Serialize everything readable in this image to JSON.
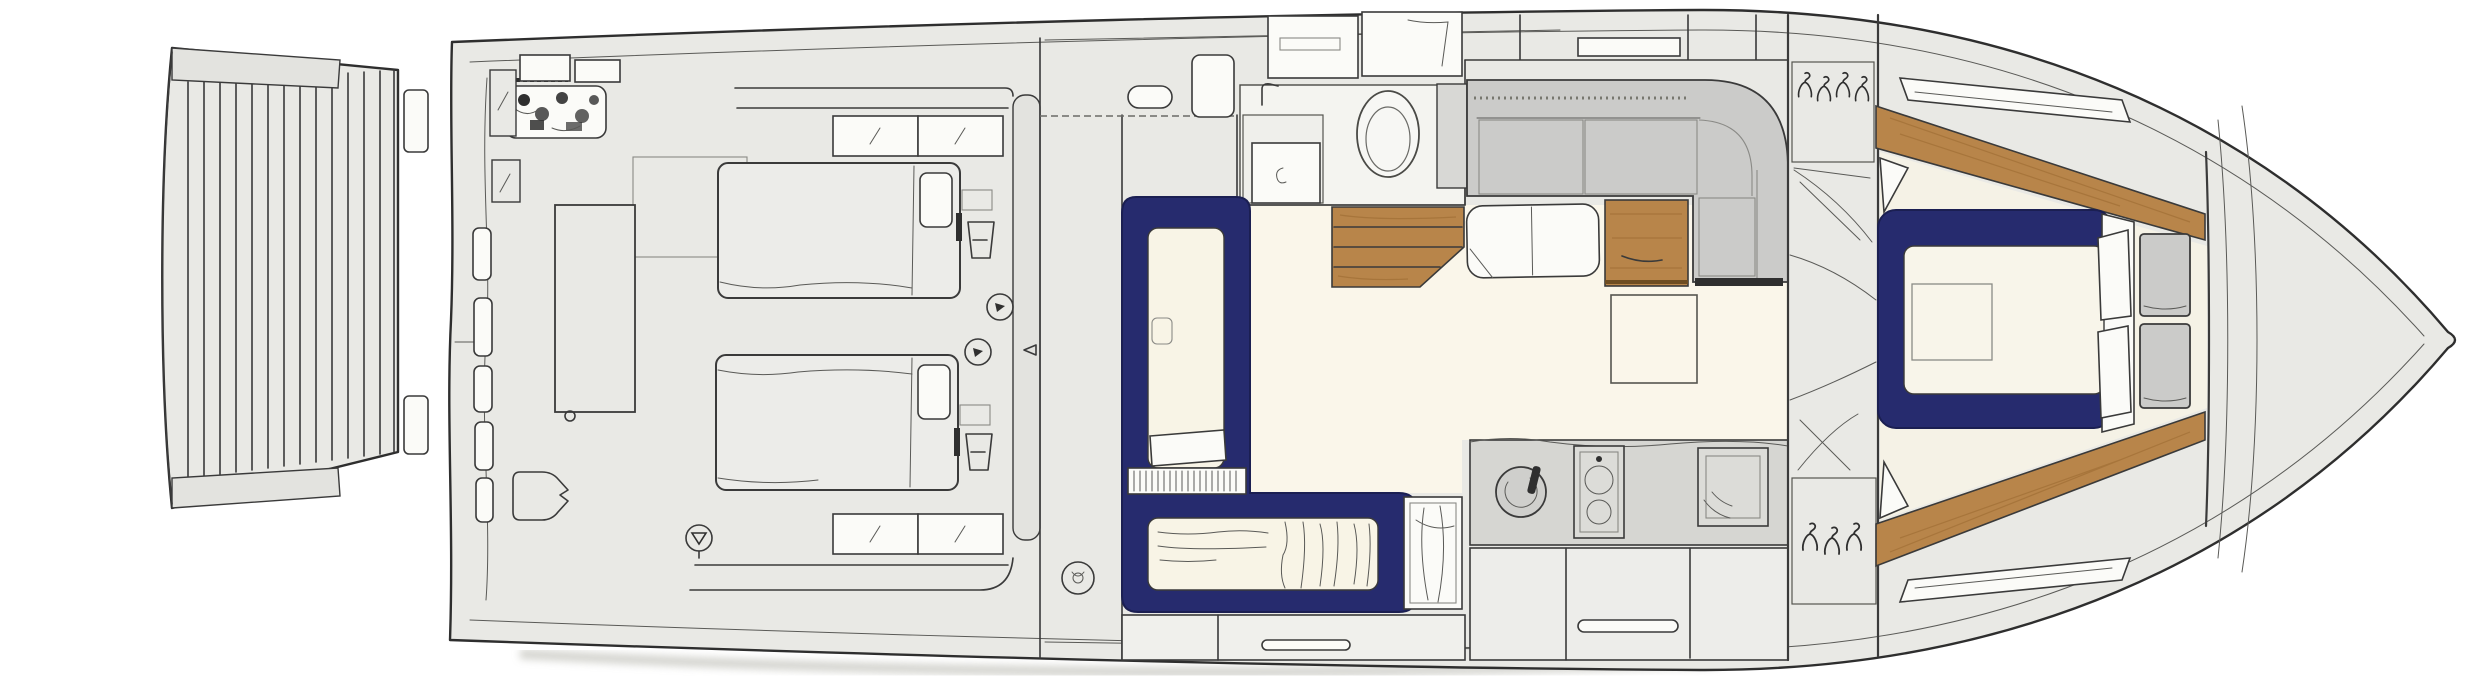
{
  "meta": {
    "title": "Motor yacht lower-deck floor plan",
    "width_px": 2480,
    "height_px": 680,
    "orientation": "bow-right"
  },
  "colors": {
    "hull": "#e9e9e5",
    "line": "#3a3a3a",
    "navy": "#262b6e",
    "cream": "#f8f4e6",
    "floor": "#faf6ea",
    "wood": "#b8854a",
    "grain": "#99672f",
    "gray": "#cbcbc9",
    "graydark": "#9f9f9d",
    "counter": "#d6d6d2",
    "white": "#fbfbf8",
    "shadow": "#c6c6bf",
    "panel": "#e3e3df"
  },
  "rooms": {
    "swim_platform": {
      "label": "Swim platform with teak planking",
      "plank_count": 14
    },
    "transom": {
      "label": "Transom and boarding steps",
      "step_pads": 2
    },
    "aft_cabin": {
      "label": "Aft guest cabin with twin beds",
      "fixtures": [
        "twin-bed-port",
        "twin-bed-starboard",
        "headboard-console",
        "nightstand-lamps",
        "reading-lights",
        "tall-table",
        "seat",
        "equipment-locker",
        "storage-lockers",
        "hull-window-strips",
        "window-boxes",
        "compass-marker"
      ],
      "window_boxes_top": 2,
      "window_boxes_bottom": 2,
      "hull_window_strips": 5
    },
    "corridor": {
      "label": "Side corridor",
      "fixtures": [
        "deck-fitting",
        "bench-pill",
        "side-table"
      ]
    },
    "bunk_cabin": {
      "label": "Guest berth cabin with navy L-shaped berths",
      "fixtures": [
        "vertical-berth",
        "horizontal-berth",
        "slatted-shelf",
        "shower-cabin",
        "drawer-bank"
      ]
    },
    "head": {
      "label": "Bathroom (head)",
      "fixtures": [
        "toilet",
        "vanity",
        "faucet",
        "overhead-cabinets"
      ]
    },
    "companionway": {
      "label": "Teak companionway steps",
      "steps": 3
    },
    "salon": {
      "label": "Salon and dinette",
      "fixtures": [
        "l-shaped-sofa",
        "dinette-table",
        "bench-seat",
        "wood-cabinet",
        "side-window"
      ]
    },
    "galley": {
      "label": "Galley",
      "fixtures": [
        "sink",
        "stove-two-burners",
        "oven",
        "drawer-handle",
        "cabinet-bank"
      ],
      "burners": 2
    },
    "wardrobes": {
      "label": "Wardrobes at master bulkhead",
      "hangers_top": 4,
      "hangers_bottom": 3
    },
    "master_cabin": {
      "label": "Master cabin in the bow",
      "fixtures": [
        "double-bed-navy",
        "mattress",
        "duvet-fold",
        "pillows",
        "bedside-cushions",
        "teak-side-panels",
        "deck-hatches",
        "nightstand-sketches"
      ]
    },
    "bow_deck": {
      "label": "Foredeck"
    }
  }
}
